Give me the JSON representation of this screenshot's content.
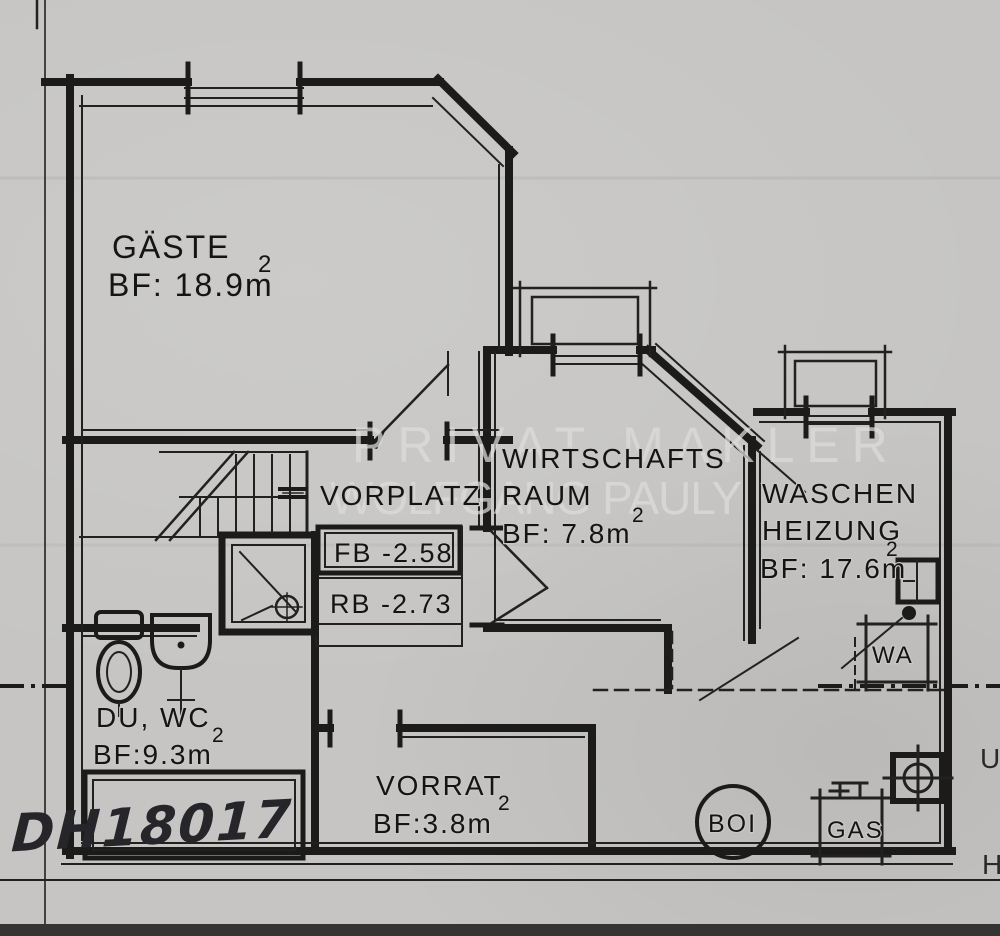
{
  "sheet": {
    "background": "#c6c5c3",
    "ink": "#1b1b19",
    "bottom_band_color": "#343432",
    "watermark": {
      "line1": "PRIVAT MAKLER",
      "line2": "WOLFGANG PAULY",
      "color": "#dedddb"
    },
    "edge_fragments": {
      "upper": "U",
      "lower": "H"
    }
  },
  "rooms": {
    "gaeste": {
      "name": "GÄSTE",
      "area": "BF: 18.9m",
      "sup": "2"
    },
    "vorplatz": {
      "name": "VORPLATZ"
    },
    "wirtschaftsraum": {
      "name_line1": "WIRTSCHAFTS",
      "name_line2": "RAUM",
      "area": "BF: 7.8m",
      "sup": "2"
    },
    "waschen_heizung": {
      "name_line1": "WASCHEN",
      "name_line2": "HEIZUNG",
      "area": "BF: 17.6m",
      "sup": "2"
    },
    "du_wc": {
      "name": "DU, WC",
      "area": "BF:9.3m",
      "sup": "2"
    },
    "vorrat": {
      "name": "VORRAT",
      "area": "BF:3.8m",
      "sup": "2"
    }
  },
  "levels": {
    "floor": "FB -2.58",
    "ceiling": "RB -2.73"
  },
  "equipment": {
    "boiler": "BOI",
    "gas": "GAS",
    "washing_machine": "WA"
  },
  "handwritten_note": "DH18017"
}
